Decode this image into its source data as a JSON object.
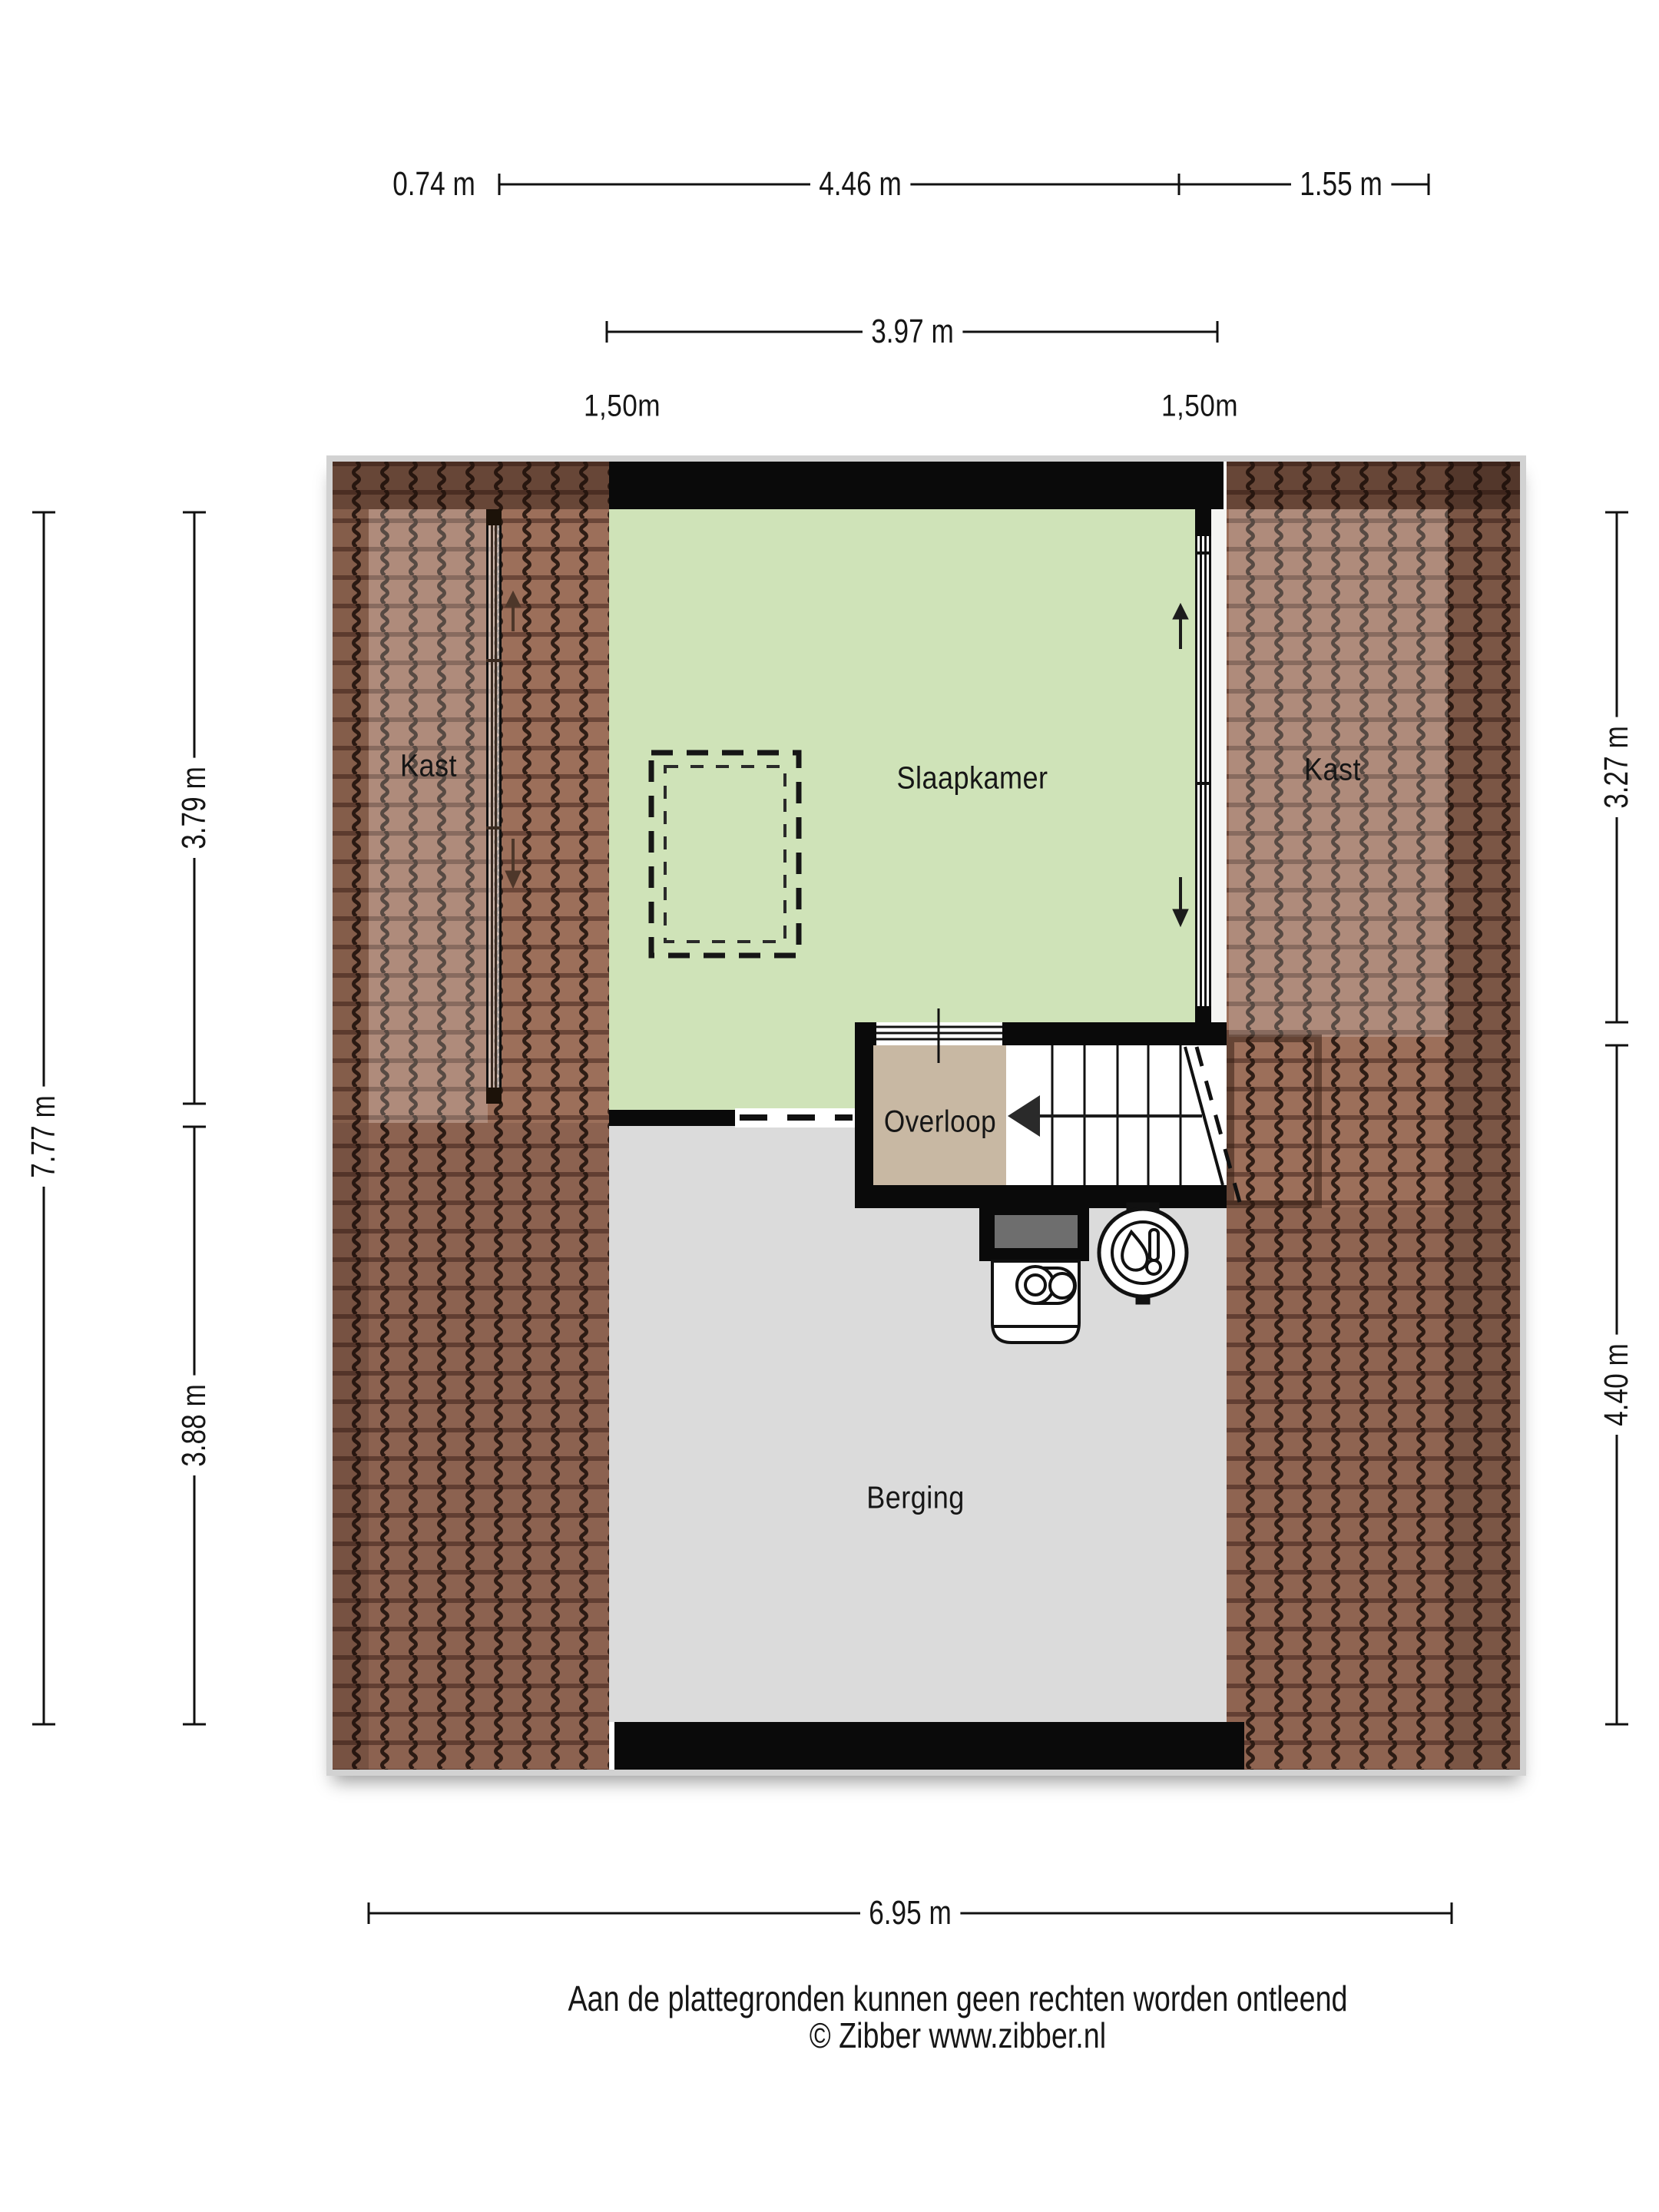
{
  "dimensions": {
    "top_row": [
      "0.74 m",
      "4.46 m",
      "1.55 m"
    ],
    "top_row2": "3.97 m",
    "headroom_labels": [
      "1,50m",
      "1,50m"
    ],
    "left_total": "7.77 m",
    "left_segments": [
      "3.79 m",
      "3.88 m"
    ],
    "right_segments": [
      "3.27 m",
      "4.40 m"
    ],
    "bottom": "6.95 m"
  },
  "rooms": {
    "kast_left": "Kast",
    "slaapkamer": "Slaapkamer",
    "kast_right": "Kast",
    "overloop": "Overloop",
    "berging": "Berging"
  },
  "footer": {
    "disclaimer": "Aan de plattegronden kunnen geen rechten worden ontleend",
    "copyright": "© Zibber www.zibber.nl"
  },
  "icons": {
    "boiler": "boiler-thermometer-icon",
    "ventilation_unit": "heat-recovery-unit-icon",
    "stairs_arrow": "stairs-direction-arrow",
    "slope_arrows": "roof-slope-arrow"
  },
  "colors": {
    "bedroom_green": "#cfe3b8",
    "landing_beige": "#c8b8a3",
    "storage_grey": "#dbdbdb",
    "wall_black": "#0a0a0a",
    "roof_tile_brown": "#9c6f5a",
    "duct_grey": "#6e6e6e"
  }
}
